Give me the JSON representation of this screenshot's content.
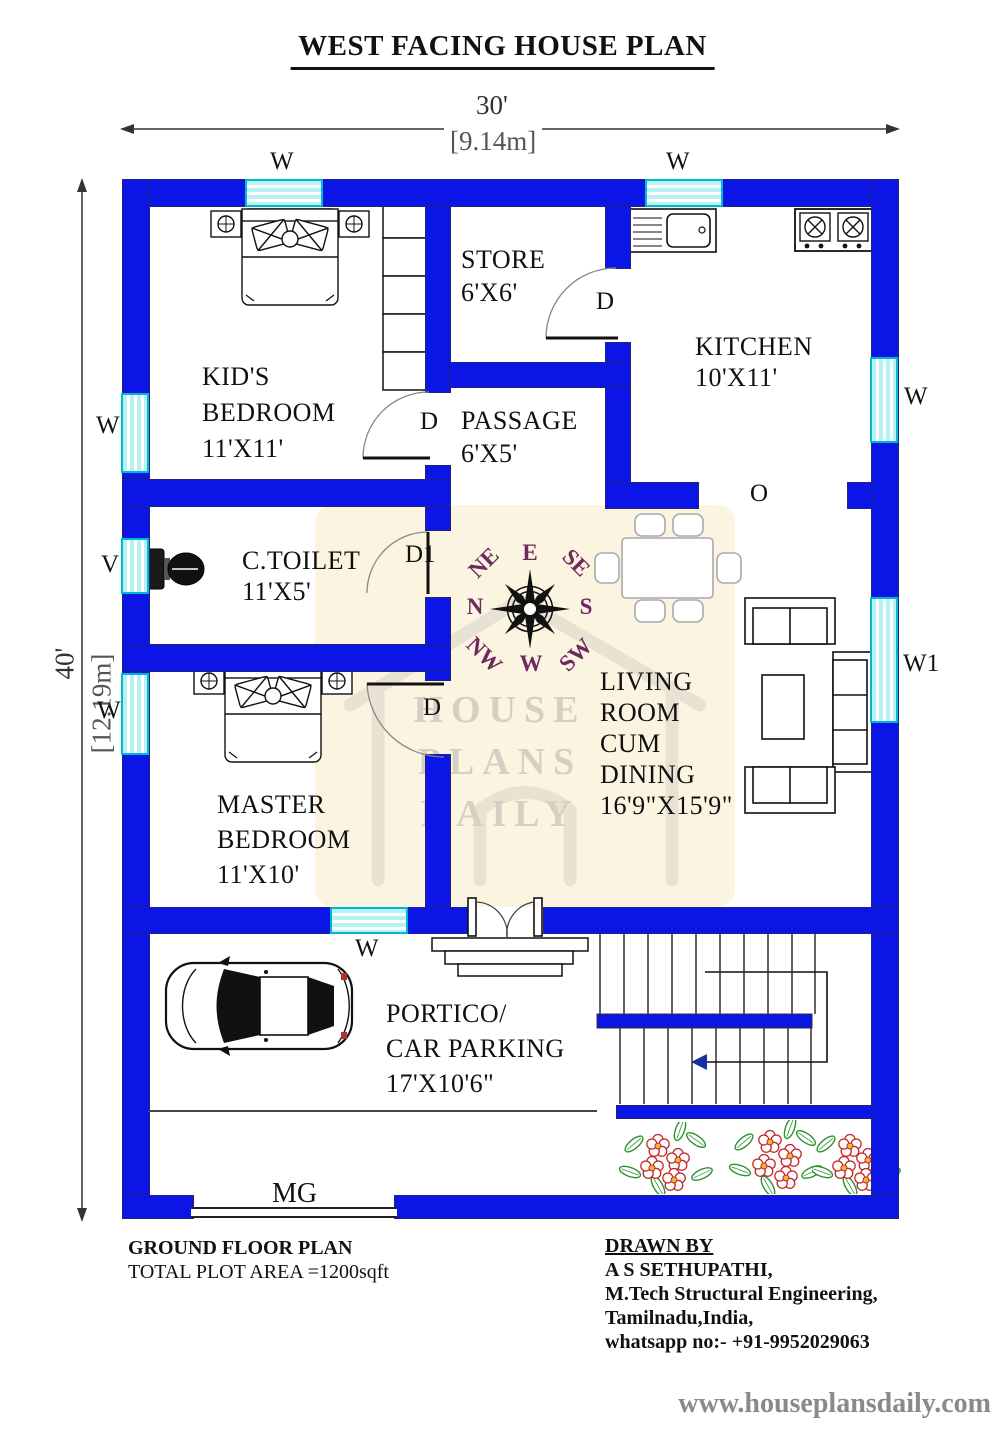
{
  "title": "WEST FACING HOUSE PLAN",
  "dimensions": {
    "width_ft": "30'",
    "width_m": "[9.14m]",
    "height_ft": "40'",
    "height_m": "[12.19m]"
  },
  "rooms": {
    "kids_bedroom": "KID'S\nBEDROOM\n11'X11'",
    "store": "STORE\n6'X6'",
    "kitchen": "KITCHEN\n10'X11'",
    "passage": "PASSAGE\n6'X5'",
    "toilet": "C.TOILET\n11'X5'",
    "living": "LIVING\nROOM\nCUM\nDINING\n16'9\"X15'9\"",
    "master_bedroom": "MASTER\nBEDROOM\n11'X10'",
    "portico": "PORTICO/\nCAR PARKING\n17'X10'6\""
  },
  "labels": {
    "window": "W",
    "window1": "W1",
    "ventilator": "V",
    "door": "D",
    "door1": "D1",
    "opening": "O",
    "main_gate": "MG"
  },
  "compass": {
    "e": "E",
    "se": "SE",
    "s": "S",
    "sw": "SW",
    "w": "W",
    "nw": "NW",
    "n": "N",
    "ne": "NE"
  },
  "watermark": "HOUSE\nPLANS\nDAILY",
  "footer": {
    "plan_name": "GROUND FLOOR PLAN",
    "plot_area": "TOTAL PLOT AREA =1200sqft",
    "drawn_by_heading": "DRAWN BY",
    "author": "A S SETHUPATHI,",
    "qualification": "M.Tech Structural Engineering,",
    "location": "Tamilnadu,India,",
    "contact": "whatsapp no:- +91-9952029063",
    "website": "www.houseplansdaily.com"
  },
  "colors": {
    "wall": "#0b16e6",
    "window": "#b8f1f4",
    "window_border": "#00b9cf",
    "cream": "#fbf4e0",
    "compass_text": "#6e2a5f",
    "watermark": "#d6d0c4"
  }
}
